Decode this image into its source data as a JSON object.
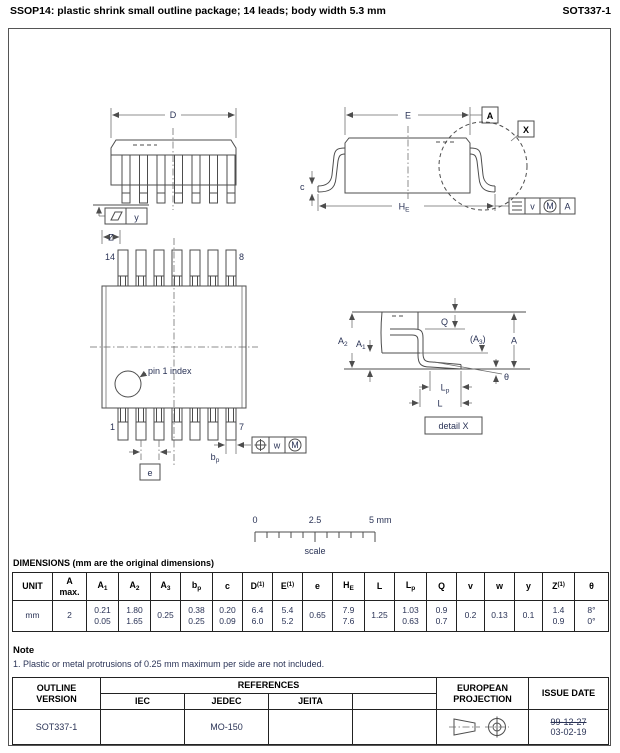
{
  "header": {
    "title": "SSOP14: plastic shrink small outline package; 14 leads; body width 5.3 mm",
    "doc_code": "SOT337-1"
  },
  "front_view": {
    "d": "D",
    "y": "y"
  },
  "side_view": {
    "e": "E",
    "datum_a": "A",
    "detail_ref": "X",
    "c": "c",
    "he_main": "H",
    "he_sub": "E",
    "tol_v": "v",
    "tol_m": "M",
    "tol_datum": "A"
  },
  "top_view": {
    "z": "Z",
    "pin_14": "14",
    "pin_8": "8",
    "pin_1": "1",
    "pin_7": "7",
    "pin1_index": "pin 1 index",
    "e": "e",
    "bp_main": "b",
    "bp_sub": "p",
    "tol_w": "w",
    "tol_m": "M"
  },
  "detail_view": {
    "a2_main": "A",
    "a2_sub": "2",
    "a1_main": "A",
    "a1_sub": "1",
    "q": "Q",
    "a3_open": "(A",
    "a3_sub": "3",
    "a3_close": ")",
    "a": "A",
    "theta": "θ",
    "lp_main": "L",
    "lp_sub": "p",
    "l": "L",
    "caption": "detail X"
  },
  "scale_bar": {
    "tick0": "0",
    "tick_mid": "2.5",
    "tick_end": "5 mm",
    "caption": "scale"
  },
  "dimensions": {
    "heading": "DIMENSIONS (mm are the original dimensions)",
    "headers": [
      {
        "main": "UNIT"
      },
      {
        "main": "A",
        "bottom": "max."
      },
      {
        "main": "A",
        "sub": "1"
      },
      {
        "main": "A",
        "sub": "2"
      },
      {
        "main": "A",
        "sub": "3"
      },
      {
        "main": "b",
        "sub": "p"
      },
      {
        "main": "c"
      },
      {
        "main": "D",
        "sup": "(1)"
      },
      {
        "main": "E",
        "sup": "(1)"
      },
      {
        "main": "e"
      },
      {
        "main": "H",
        "sub": "E"
      },
      {
        "main": "L"
      },
      {
        "main": "L",
        "sub": "p"
      },
      {
        "main": "Q"
      },
      {
        "main": "v"
      },
      {
        "main": "w"
      },
      {
        "main": "y"
      },
      {
        "main": "Z",
        "sup": "(1)"
      },
      {
        "main": "θ"
      }
    ],
    "values": [
      [
        "mm"
      ],
      [
        "2"
      ],
      [
        "0.21",
        "0.05"
      ],
      [
        "1.80",
        "1.65"
      ],
      [
        "0.25"
      ],
      [
        "0.38",
        "0.25"
      ],
      [
        "0.20",
        "0.09"
      ],
      [
        "6.4",
        "6.0"
      ],
      [
        "5.4",
        "5.2"
      ],
      [
        "0.65"
      ],
      [
        "7.9",
        "7.6"
      ],
      [
        "1.25"
      ],
      [
        "1.03",
        "0.63"
      ],
      [
        "0.9",
        "0.7"
      ],
      [
        "0.2"
      ],
      [
        "0.13"
      ],
      [
        "0.1"
      ],
      [
        "1.4",
        "0.9"
      ],
      [
        "8°",
        "0°"
      ]
    ]
  },
  "note": {
    "heading": "Note",
    "item1": "1. Plastic or metal protrusions of 0.25 mm maximum per side are not included."
  },
  "footer": {
    "outline_version_l1": "OUTLINE",
    "outline_version_l2": "VERSION",
    "references": "REFERENCES",
    "iec": "IEC",
    "jedec": "JEDEC",
    "jeita": "JEITA",
    "european_l1": "EUROPEAN",
    "european_l2": "PROJECTION",
    "issue_date": "ISSUE DATE",
    "version_value": "SOT337-1",
    "jedec_value": "MO-150",
    "issue_old": "99-12-27",
    "issue_new": "03-02-19"
  }
}
